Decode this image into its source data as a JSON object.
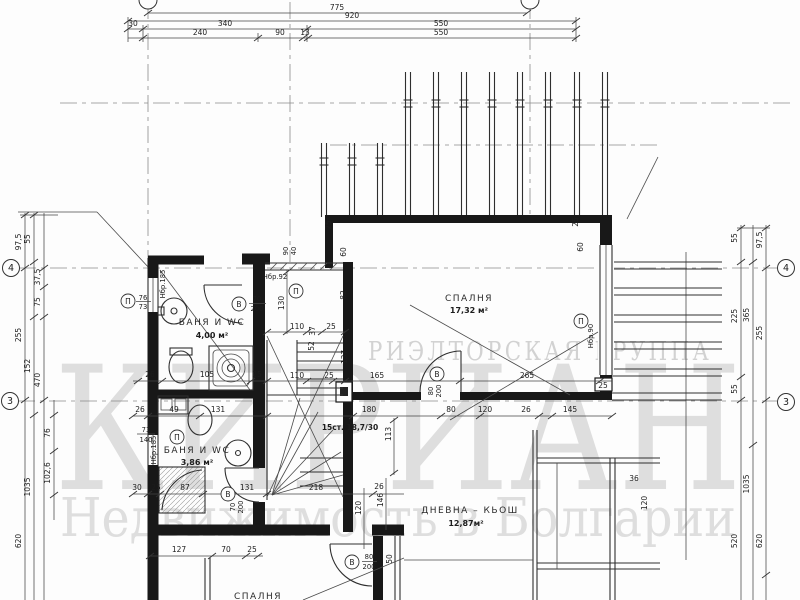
{
  "watermark": {
    "group_text": "РИЭЛТОРСКАЯ ГРУППА",
    "brand_text": "КИРИАН",
    "tagline_text": "Недвижимость в Болгарии"
  },
  "rooms": [
    {
      "name": "БАНЯ И WC",
      "area": "4,00 м²"
    },
    {
      "name": "БАНЯ И WC",
      "area": "3,86 м²"
    },
    {
      "name": "СПАЛНЯ",
      "area": "17,32 м²"
    },
    {
      "name": "ДНЕВНА – КЬОШ",
      "area": "12,87м²"
    },
    {
      "name": "СПАЛНЯ",
      "area": ""
    }
  ],
  "stairs": {
    "label": "15ст. 18,7/30"
  },
  "axes": {
    "left_top": "4",
    "left_bottom": "3",
    "right_top": "4",
    "right_bottom": "3"
  },
  "dims": {
    "top": [
      "775",
      "920",
      "30",
      "340",
      "550",
      "240",
      "90",
      "13",
      "550"
    ],
    "left": [
      "97,5",
      "55",
      "37,5",
      "75",
      "255",
      "152",
      "470",
      "76",
      "102,6",
      "1035",
      "620"
    ],
    "right": [
      "55",
      "97,5",
      "225",
      "365",
      "255",
      "55",
      "1035",
      "620",
      "520"
    ],
    "inner": {
      "row_corridor": [
        "110",
        "37",
        "25"
      ],
      "row_mid": [
        "110",
        "25",
        "165",
        "265"
      ],
      "row_bath1": [
        "26",
        "105",
        "25"
      ],
      "row_415": [
        "26",
        "49",
        "131",
        "180",
        "80",
        "120",
        "26",
        "145"
      ],
      "row_494": [
        "30",
        "25",
        "87",
        "131",
        "218"
      ],
      "row_556": [
        "127",
        "70",
        "25"
      ],
      "vert": [
        "130",
        "52",
        "137",
        "113",
        "146",
        "120",
        "50",
        "120"
      ],
      "misc": [
        "26",
        "36",
        "25",
        "60",
        "82",
        "25",
        "60",
        "25",
        "90",
        "40"
      ]
    }
  },
  "openings": [
    {
      "tag": "П",
      "a": "76",
      "b": "73"
    },
    {
      "tag": "В",
      "a": "70",
      "b": "200"
    },
    {
      "tag": "П",
      "note": "Нбр.185"
    },
    {
      "tag": "П",
      "note": "Нбр.92"
    },
    {
      "tag": "П",
      "a": "73",
      "b": "140"
    },
    {
      "tag": "",
      "note": "Нбр.185"
    },
    {
      "tag": "В",
      "a": "70",
      "b": "200"
    },
    {
      "tag": "В",
      "a": "80",
      "b": "200"
    },
    {
      "tag": "В",
      "a": "80",
      "b": "200"
    },
    {
      "tag": "П",
      "note": "Нбр.90"
    }
  ]
}
